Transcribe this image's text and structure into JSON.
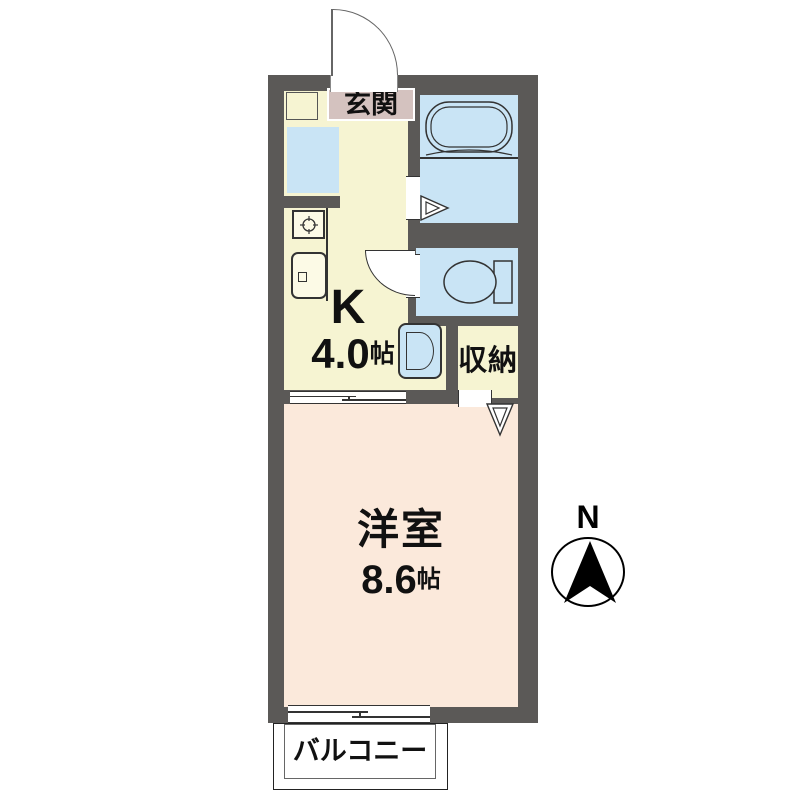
{
  "floorplan": {
    "genkan": {
      "label": "玄関"
    },
    "kitchen": {
      "code": "K",
      "area": "4.0",
      "unit": "帖"
    },
    "storage": {
      "label": "収納"
    },
    "western_room": {
      "label": "洋室",
      "area": "8.6",
      "unit": "帖"
    },
    "balcony": {
      "label": "バルコニー"
    },
    "compass": {
      "label": "N"
    }
  },
  "colors": {
    "wall": "#5b5957",
    "kitchen_floor": "#f6f4d2",
    "western_room_floor": "#fbe9db",
    "wet_area": "#c9e4f5",
    "genkan_floor": "#d4c2bf",
    "balcony": "#ffffff",
    "line": "#333333",
    "text": "#111111"
  },
  "icons": [
    "bathtub-icon",
    "toilet-icon",
    "washing-machine-icon",
    "refrigerator-space",
    "stove-icon",
    "sink-icon",
    "entrance-door-arc-icon",
    "toilet-door-arc-icon",
    "folding-door-icon",
    "closet-folding-door-icon",
    "sliding-door-icon",
    "sliding-window-icon",
    "compass-north-icon"
  ]
}
